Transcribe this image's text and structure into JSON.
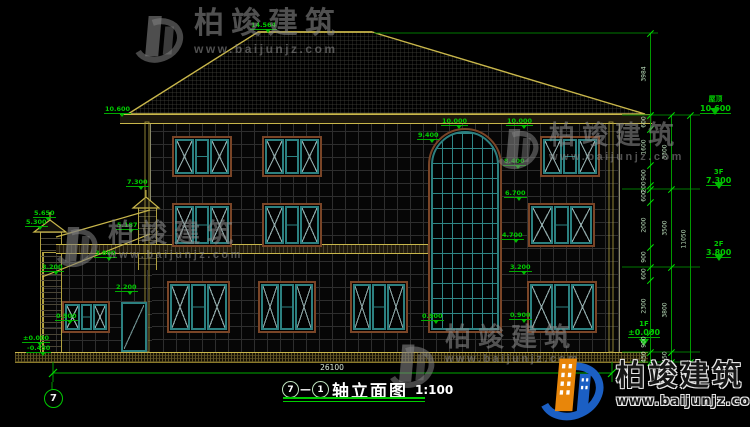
{
  "title_block": {
    "axis_from": "7",
    "axis_to": "1",
    "text": "轴立面图",
    "scale": "1:100"
  },
  "annotations": {
    "overall_width": "26100",
    "axis_bubble": "7"
  },
  "watermark": {
    "name_cn": "柏竣建筑",
    "url": "www.baijunjz.com"
  },
  "brand": {
    "name_cn": "柏竣建筑",
    "url": "www.baijunjz.com"
  },
  "right_levels": [
    {
      "label": "屋顶",
      "value": "10.600",
      "x": 700,
      "y": 94,
      "ty": 108
    },
    {
      "label": "3F",
      "value": "7.300",
      "x": 706,
      "y": 168,
      "ty": 182
    },
    {
      "label": "2F",
      "value": "3.800",
      "x": 706,
      "y": 240,
      "ty": 254
    },
    {
      "label": "1F",
      "value": "±0.000",
      "x": 628,
      "y": 320,
      "ty": 339
    }
  ],
  "markers": [
    {
      "v": "14.564",
      "x": 250,
      "y": 22
    },
    {
      "v": "10.600",
      "x": 104,
      "y": 106
    },
    {
      "v": "10.000",
      "x": 441,
      "y": 118
    },
    {
      "v": "10.000",
      "x": 506,
      "y": 118
    },
    {
      "v": "9.400",
      "x": 417,
      "y": 132
    },
    {
      "v": "8.400",
      "x": 503,
      "y": 158
    },
    {
      "v": "7.300",
      "x": 126,
      "y": 179
    },
    {
      "v": "6.700",
      "x": 504,
      "y": 190
    },
    {
      "v": "5.650",
      "x": 33,
      "y": 210
    },
    {
      "v": "5.300",
      "x": 25,
      "y": 219
    },
    {
      "v": "5.187",
      "x": 116,
      "y": 222
    },
    {
      "v": "4.700",
      "x": 501,
      "y": 232
    },
    {
      "v": "3.800",
      "x": 94,
      "y": 250
    },
    {
      "v": "3.200",
      "x": 41,
      "y": 264
    },
    {
      "v": "3.200",
      "x": 509,
      "y": 264
    },
    {
      "v": "2.200",
      "x": 115,
      "y": 284
    },
    {
      "v": "0.900",
      "x": 55,
      "y": 313
    },
    {
      "v": "0.900",
      "x": 421,
      "y": 313
    },
    {
      "v": "0.900",
      "x": 509,
      "y": 312
    },
    {
      "v": "±0.000",
      "x": 22,
      "y": 335
    },
    {
      "v": "-0.450",
      "x": 26,
      "y": 345
    }
  ],
  "dim_chains": [
    {
      "x": 650,
      "bounds": [
        33,
        115
      ],
      "labels": [
        "3984"
      ]
    },
    {
      "x": 650,
      "bounds": [
        115,
        129,
        165,
        185,
        189,
        202,
        247,
        267,
        280,
        332,
        352,
        362
      ],
      "labels": [
        "600",
        "1600",
        "900",
        "200",
        "600",
        "2000",
        "900",
        "600",
        "2300",
        "900",
        "450"
      ]
    },
    {
      "x": 671,
      "bounds": [
        115,
        189,
        267,
        352,
        362
      ],
      "labels": [
        "3300",
        "3500",
        "3800",
        "450"
      ]
    },
    {
      "x": 690,
      "bounds": [
        115,
        362
      ],
      "labels": [
        "11050"
      ]
    }
  ],
  "elevation": {
    "windows": [
      {
        "type": "std",
        "x": 172,
        "y": 136,
        "w": 60,
        "h": 41
      },
      {
        "type": "std",
        "x": 262,
        "y": 136,
        "w": 60,
        "h": 41
      },
      {
        "type": "std",
        "x": 540,
        "y": 136,
        "w": 60,
        "h": 41
      },
      {
        "type": "std",
        "x": 172,
        "y": 203,
        "w": 60,
        "h": 44
      },
      {
        "type": "std",
        "x": 262,
        "y": 203,
        "w": 60,
        "h": 44
      },
      {
        "type": "std",
        "x": 528,
        "y": 203,
        "w": 67,
        "h": 44
      },
      {
        "type": "std",
        "x": 167,
        "y": 281,
        "w": 63,
        "h": 52
      },
      {
        "type": "std",
        "x": 258,
        "y": 281,
        "w": 58,
        "h": 52
      },
      {
        "type": "std",
        "x": 350,
        "y": 281,
        "w": 58,
        "h": 52
      },
      {
        "type": "std",
        "x": 527,
        "y": 281,
        "w": 70,
        "h": 52
      },
      {
        "type": "std",
        "x": 62,
        "y": 301,
        "w": 48,
        "h": 32
      },
      {
        "type": "arch",
        "x": 428,
        "y": 128,
        "w": 74,
        "h": 205
      },
      {
        "type": "door",
        "x": 121,
        "y": 302,
        "w": 26,
        "h": 50
      }
    ]
  }
}
